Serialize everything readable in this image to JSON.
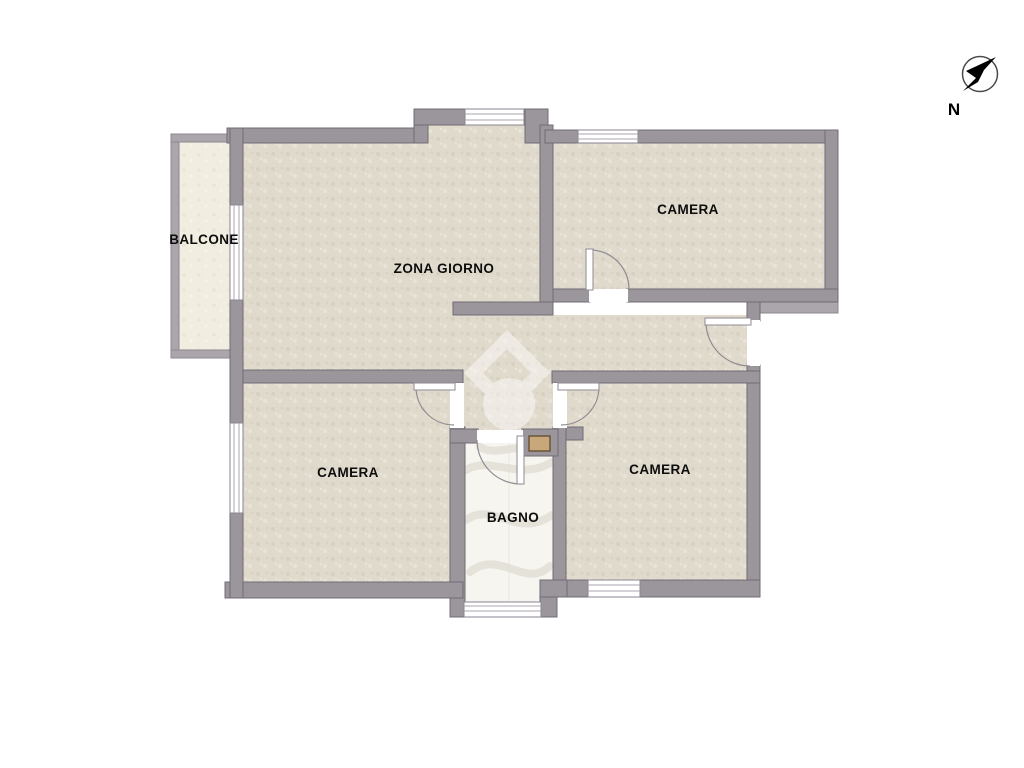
{
  "type": "floor-plan",
  "rooms": {
    "balcone": {
      "label": "BALCONE"
    },
    "zona_giorno": {
      "label": "ZONA GIORNO"
    },
    "camera_top": {
      "label": "CAMERA"
    },
    "camera_left": {
      "label": "CAMERA"
    },
    "camera_right": {
      "label": "CAMERA"
    },
    "bagno": {
      "label": "BAGNO"
    }
  },
  "compass": {
    "label": "N"
  },
  "palette": {
    "wall": "#9b959c",
    "wall_outline": "#716c75",
    "light_wall": "#aba6ac",
    "floor": "#e0dacd",
    "balcony_floor": "#f1ede0",
    "bath_floor": "#f7f5f0",
    "door_symbol": "#8f8a92",
    "background": "#ffffff",
    "text": "#0d0d0d"
  }
}
